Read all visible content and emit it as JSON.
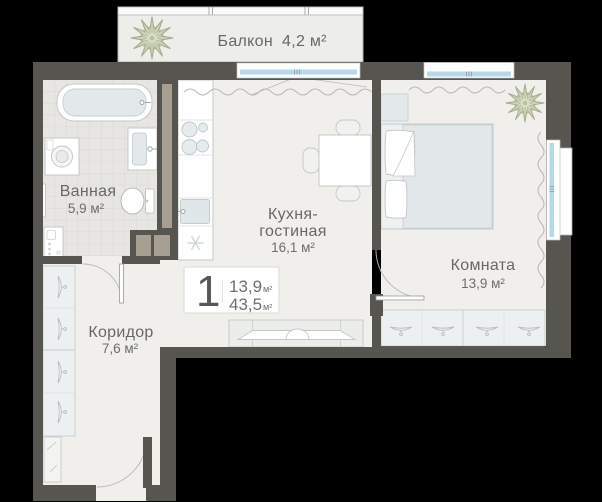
{
  "plan": {
    "badge": {
      "rooms_count": "1",
      "living_area": "13,9",
      "living_area_unit": "м²",
      "total_area": "43,5",
      "total_area_unit": "м²"
    },
    "rooms": {
      "balcony": {
        "name": "Балкон",
        "area": "4,2 м²"
      },
      "bathroom": {
        "name": "Ванная",
        "area": "5,9 м²"
      },
      "kitchen_living": {
        "name_line1": "Кухня-",
        "name_line2": "гостиная",
        "area": "16,1 м²"
      },
      "bedroom": {
        "name": "Комната",
        "area": "13,9 м²"
      },
      "corridor": {
        "name": "Коридор",
        "area": "7,6 м²"
      }
    },
    "colors": {
      "background": "#000000",
      "wall": "#575550",
      "wall_duct_accent": "#a79f92",
      "floor": "#f0efeb",
      "bathroom_tile": "#e7e6e3",
      "window_glass": "#b5d9ec",
      "balcony_floor": "#edeeea",
      "plant": "#cbd1b6",
      "label_text": "#686868"
    }
  }
}
